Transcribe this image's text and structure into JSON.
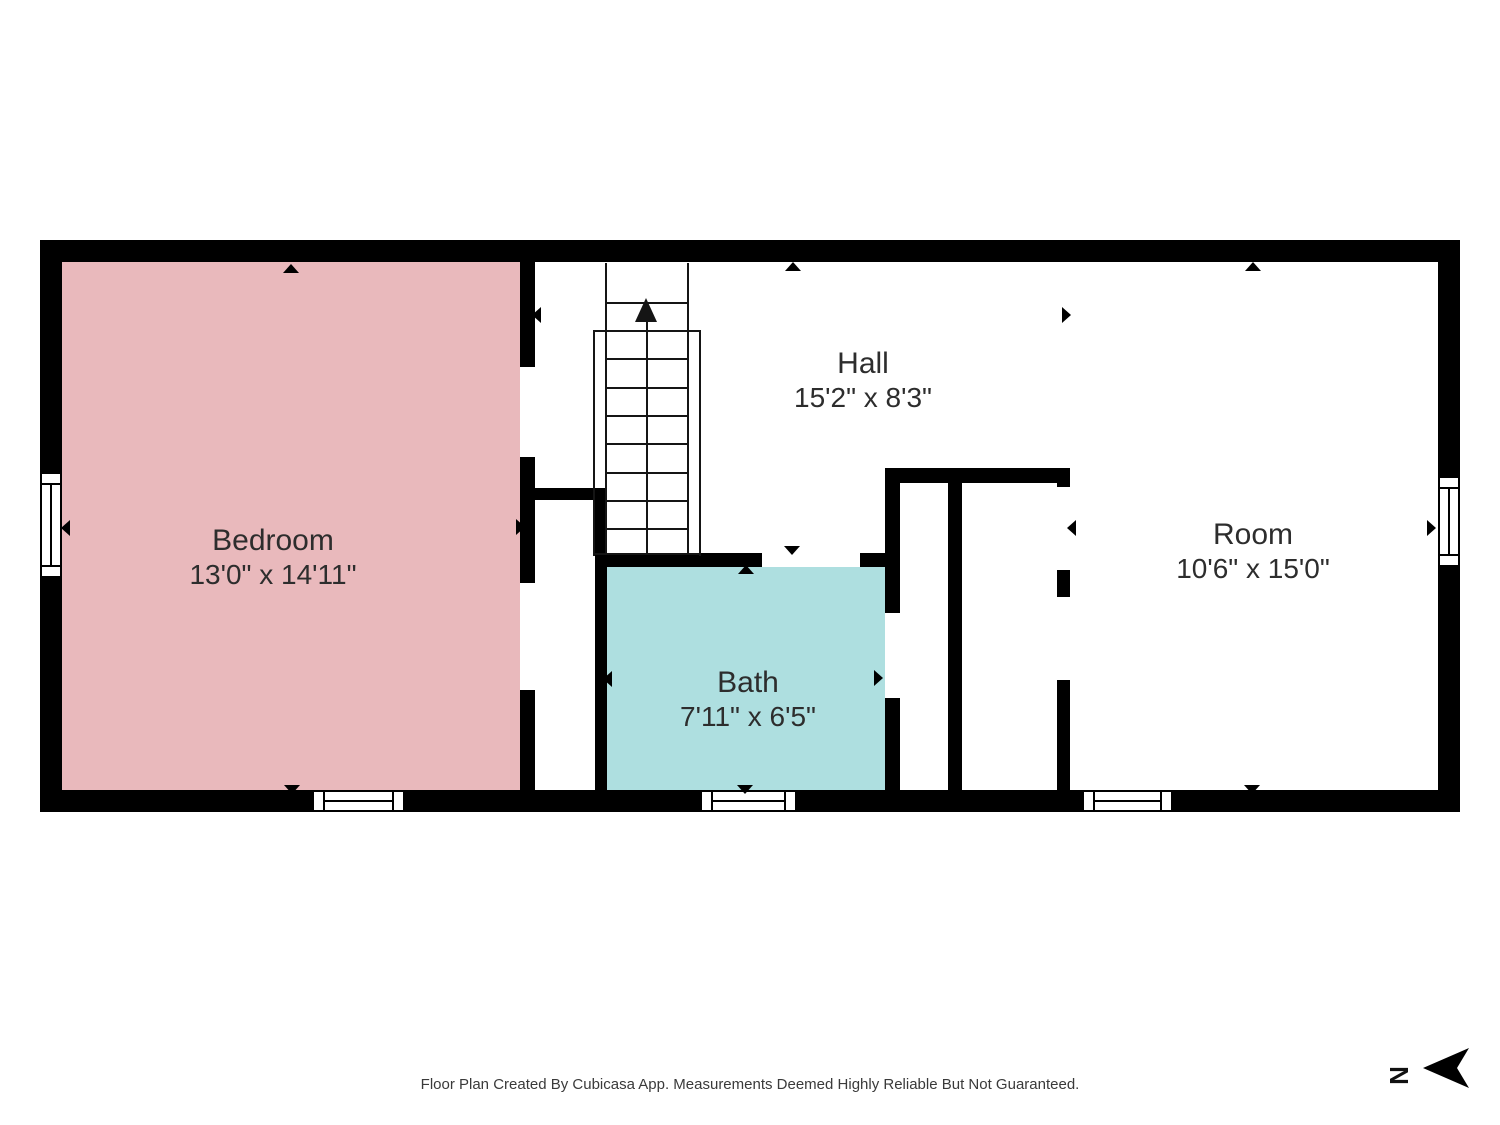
{
  "rooms": [
    {
      "id": "bedroom",
      "name": "Bedroom",
      "dims": "13'0\" x 14'11\""
    },
    {
      "id": "hall",
      "name": "Hall",
      "dims": "15'2\" x 8'3\""
    },
    {
      "id": "bath",
      "name": "Bath",
      "dims": "7'11\" x 6'5\""
    },
    {
      "id": "room",
      "name": "Room",
      "dims": "10'6\" x 15'0\""
    }
  ],
  "colors": {
    "bedroom_fill": "#e9b9bc",
    "bath_fill": "#aedfe0",
    "wall": "#000000",
    "text": "#2d2d2d"
  },
  "footer": {
    "disclaimer": "Floor Plan Created By Cubicasa App. Measurements Deemed Highly Reliable But Not Guaranteed."
  },
  "compass": {
    "north_label": "N"
  }
}
